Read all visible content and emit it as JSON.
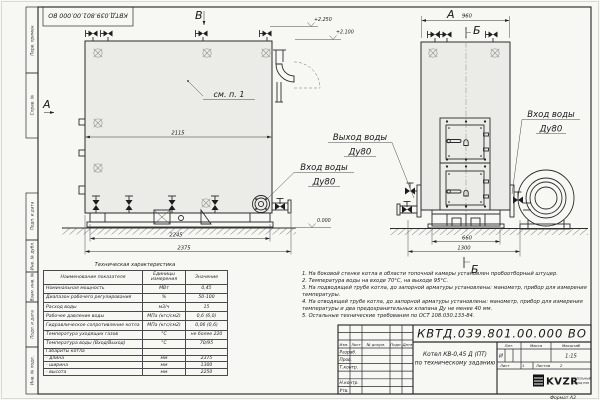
{
  "tb": {
    "designation": "КВТД.039.801.00.000 ВО",
    "name1": "Котел КВ-0,45 Д (ПТ)",
    "name2": "по техническому заданию",
    "c_izm": "Изм.",
    "c_list": "Лист",
    "c_doc": "№ докум.",
    "c_podp": "Подп.",
    "c_data": "Дата",
    "r1": "Разраб.",
    "r2": "Пров.",
    "r3": "Т.контр.",
    "r4": "Н.контр.",
    "r5": "Утв.",
    "h_lit": "Лит.",
    "h_mass": "Масса",
    "h_scale": "Масштаб",
    "lit": "И",
    "scale": "1:15",
    "sheet_l": "Лист",
    "sheet_v": "1",
    "sheets_l": "Листов",
    "sheets_v": "2",
    "logo": "KVZR",
    "logo1": "КОТЕЛЬНЫЙ",
    "logo2": "ЗАВОД РЭП",
    "format": "Формат А3"
  },
  "margin": {
    "b1": "Перв. примен.",
    "b2": "Справ. №",
    "b3": "Подп. и дата",
    "b4": "Инв. № дубл.",
    "b5": "Взам. инв. №",
    "b6": "Подп. и дата",
    "b7": "Инв. № подл."
  },
  "views": {
    "v_top": "В",
    "v_left": "А",
    "v_front": "А",
    "sec_top": "Б",
    "sec_bottom": "Б"
  },
  "dims": {
    "body_len": "2115",
    "base_len": "2245",
    "total_len": "2375",
    "width_a": "960",
    "base_w": "660",
    "total_w": "1300"
  },
  "elev": {
    "top": "+2.250",
    "chimney": "+2.100",
    "zero": "0.000"
  },
  "callouts": {
    "see": "см. п. 1",
    "out1": "Выход воды",
    "out2": "Ду80",
    "inL1": "Вход воды",
    "inL2": "Ду80",
    "inR1": "Вход воды",
    "inR2": "Ду80"
  },
  "spec": {
    "title": "Техническая характеристика",
    "h": [
      "Наименование показателя",
      "Единицы измерения",
      "Значение"
    ],
    "rows": [
      [
        "Номинальная мощность",
        "МВт",
        "0,45"
      ],
      [
        "Диапазон рабочего регулирования",
        "%",
        "50-100"
      ],
      [
        "Расход воды",
        "м3/ч",
        "15"
      ],
      [
        "Рабочее давление воды",
        "МПа (кгс/см2)",
        "0,6 (6,0)"
      ],
      [
        "Гидравлическое сопротивление котла",
        "МПа (кгс/см2)",
        "0,06 (0,6)"
      ],
      [
        "Температура уходящих газов",
        "°С",
        "не более 220"
      ],
      [
        "Температура воды (Вход/Выход)",
        "°С",
        "70/95"
      ],
      [
        "Габариты котла",
        "",
        ""
      ],
      [
        "- длина",
        "мм",
        "2375"
      ],
      [
        "- ширина",
        "мм",
        "1300"
      ],
      [
        "- высота",
        "мм",
        "2250"
      ]
    ]
  },
  "notes": [
    "1. На боковой стенке котла в области топочной камеры установлен пробоотборный штуцер.",
    "2. Температура воды на входе 70°С, на выходе 95°С.",
    "3. На подводящей трубе котла, до запорной арматуры установлены: манометр, прибор для измерения температуры.",
    "4. На отводящей трубе котла, до запорной арматуры установлены: манометр, прибор для измерения температуры и два предохранительных клапана Ду не менее 40 мм.",
    "5. Остальные технические требования по ОСТ 108.030.133-84."
  ]
}
